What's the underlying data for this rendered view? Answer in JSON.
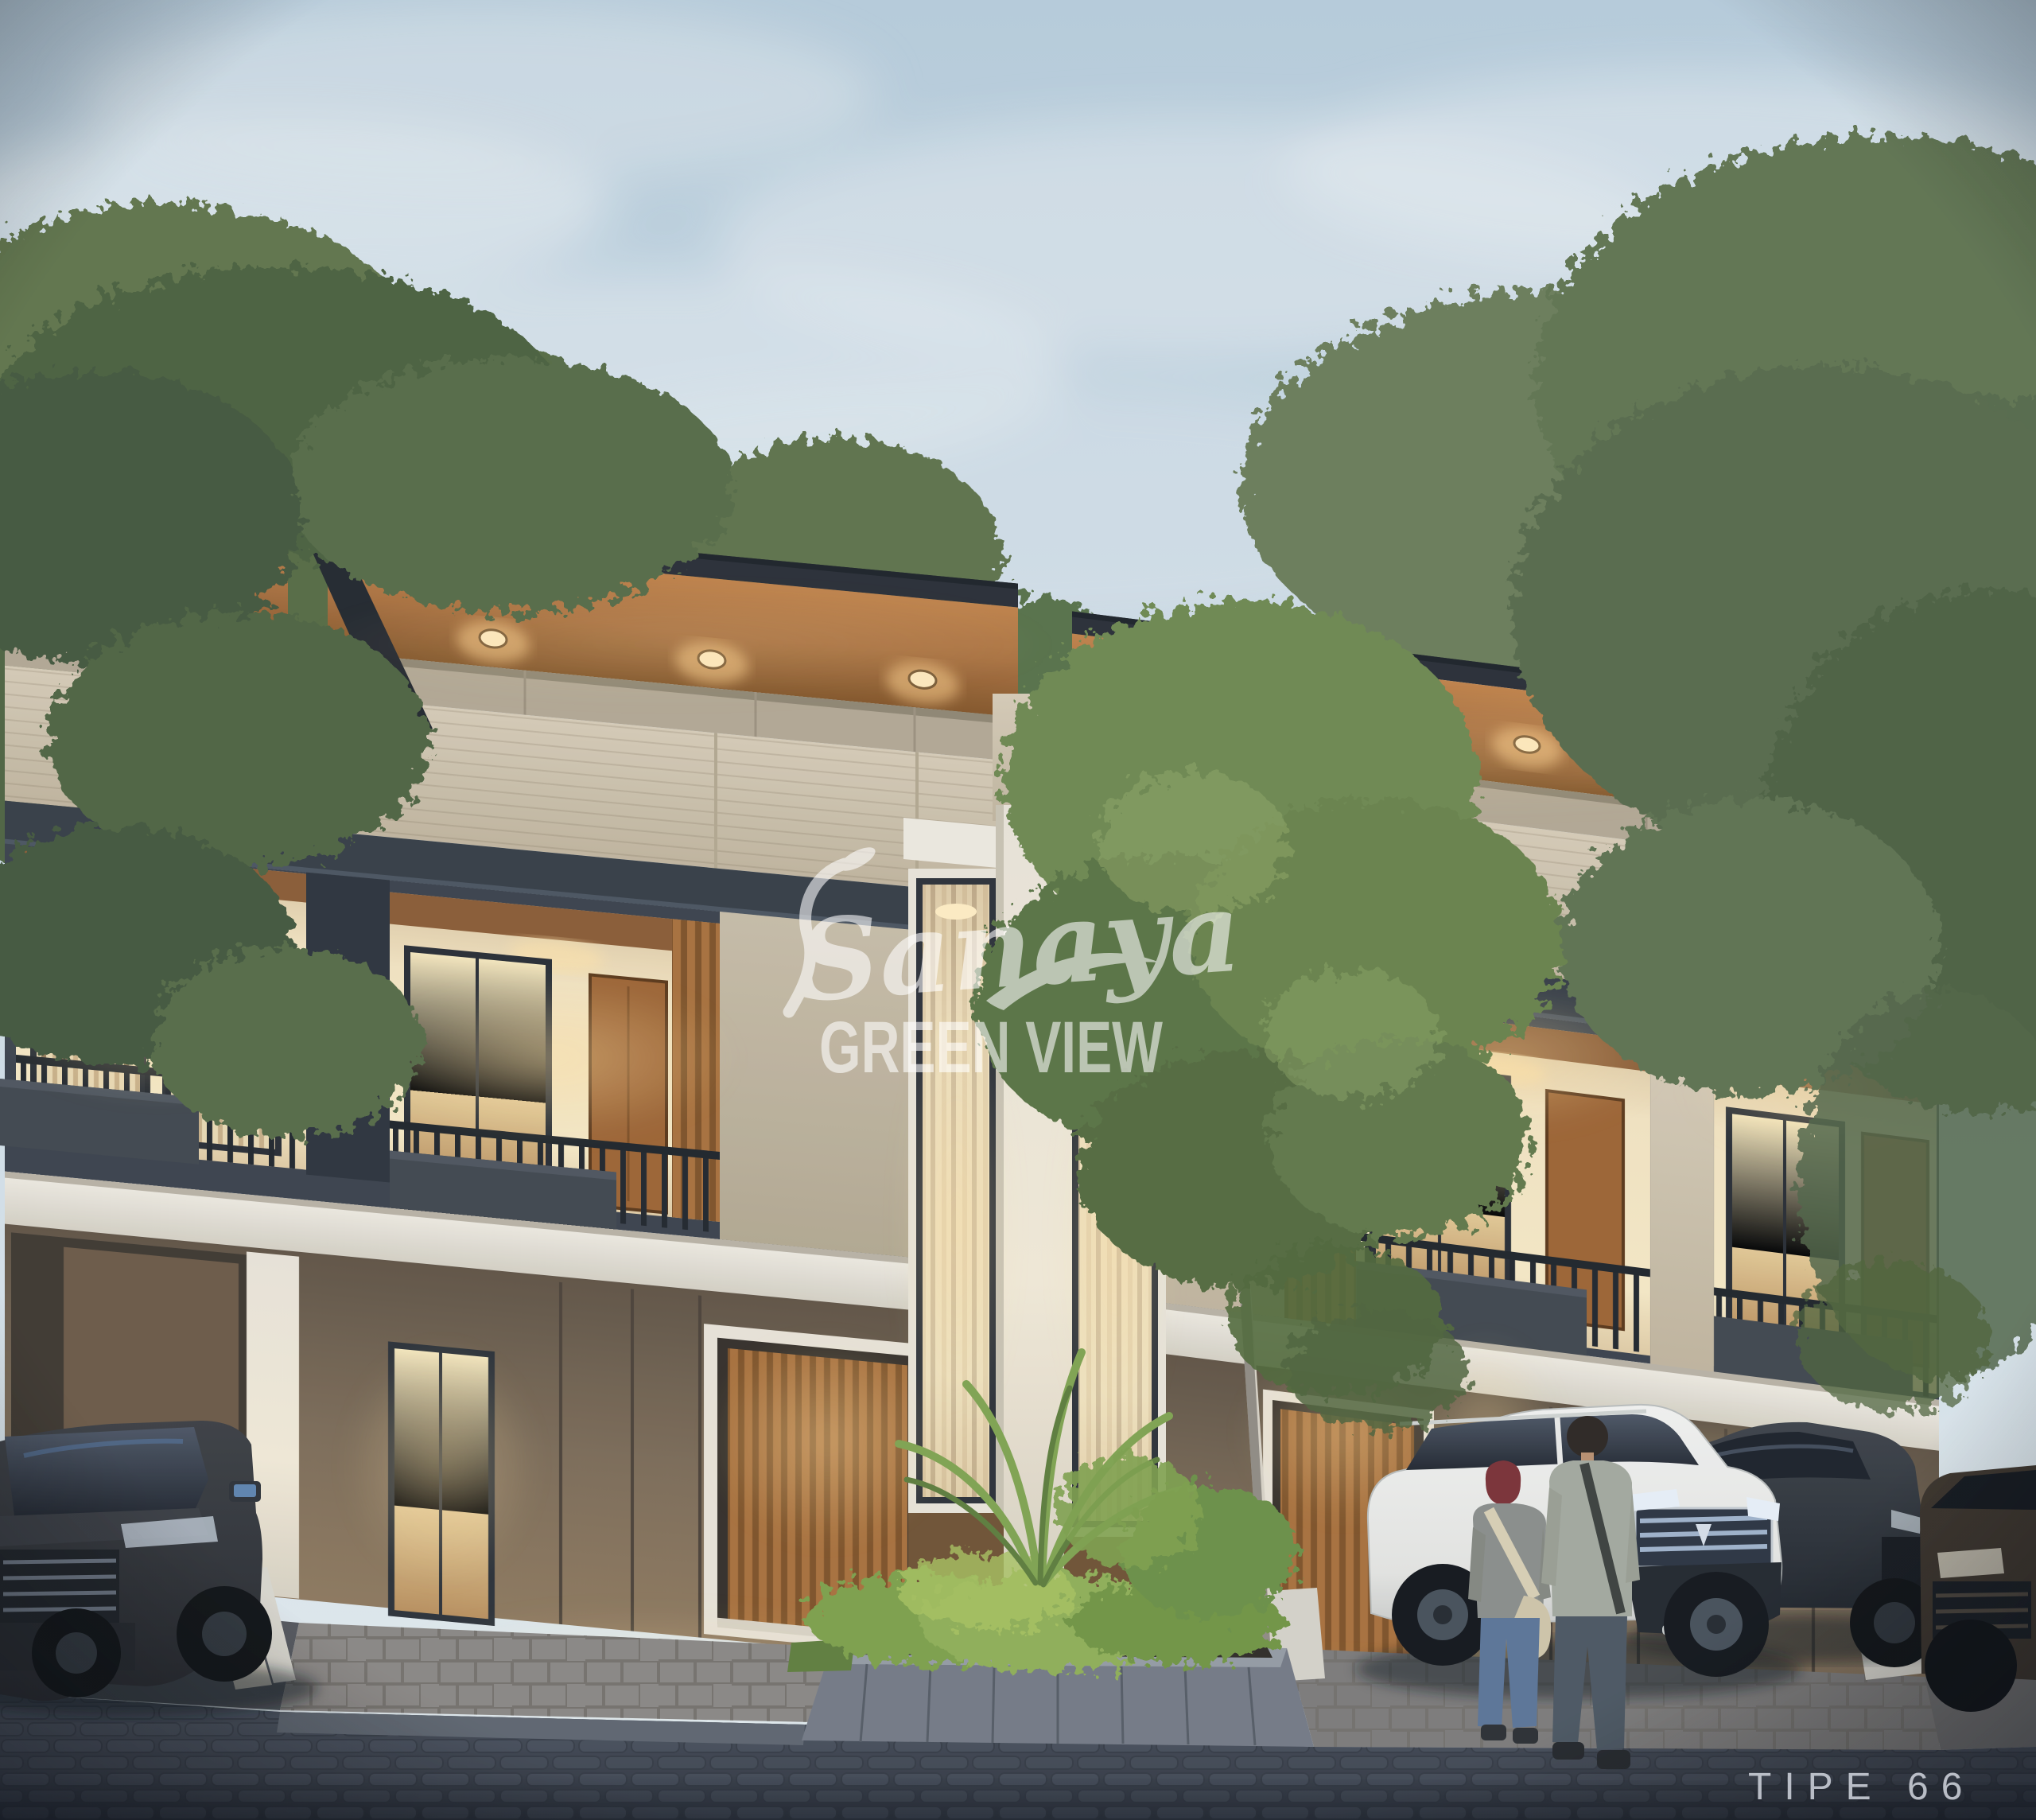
{
  "scene": {
    "type": "architectural exterior render",
    "time_of_day": "dusk",
    "subject": "two-story modern townhouse row with lit interiors",
    "units_visible": 4,
    "cars": [
      {
        "position": "far-left carport",
        "color_name": "dark gray SUV",
        "hex": "#32353b"
      },
      {
        "position": "center-right driveway",
        "color_name": "white SUV",
        "hex": "#e9e9e7"
      },
      {
        "position": "right driveway",
        "color_name": "charcoal SUV",
        "hex": "#2b3036"
      },
      {
        "position": "far-right edge",
        "color_name": "dark bronze SUV",
        "hex": "#393129"
      }
    ],
    "people": [
      {
        "description": "woman with maroon headscarf, gray top, blue jeans, cream sling bag"
      },
      {
        "description": "man with sage jacket, dark jeans, shoulder strap"
      }
    ]
  },
  "watermark": {
    "script_text": "Sanaya",
    "caps_text": "GREEN VIEW",
    "color": "#ffffff"
  },
  "caption": {
    "text": "TIPE 66",
    "color": "#c9ced6"
  },
  "palette": {
    "sky_top": "#b7ccdb",
    "sky_bottom": "#e4ebee",
    "roof_fascia": "#272c34",
    "wood_soffit": "#a96f3d",
    "travertine": "#cdc2ac",
    "frame_charcoal": "#343b44",
    "warm_interior": "#f2e2bf",
    "warm_light": "#ffd98f",
    "foliage": "#5d7148",
    "street": "#3f4551",
    "white_trim": "#e9e4da"
  }
}
